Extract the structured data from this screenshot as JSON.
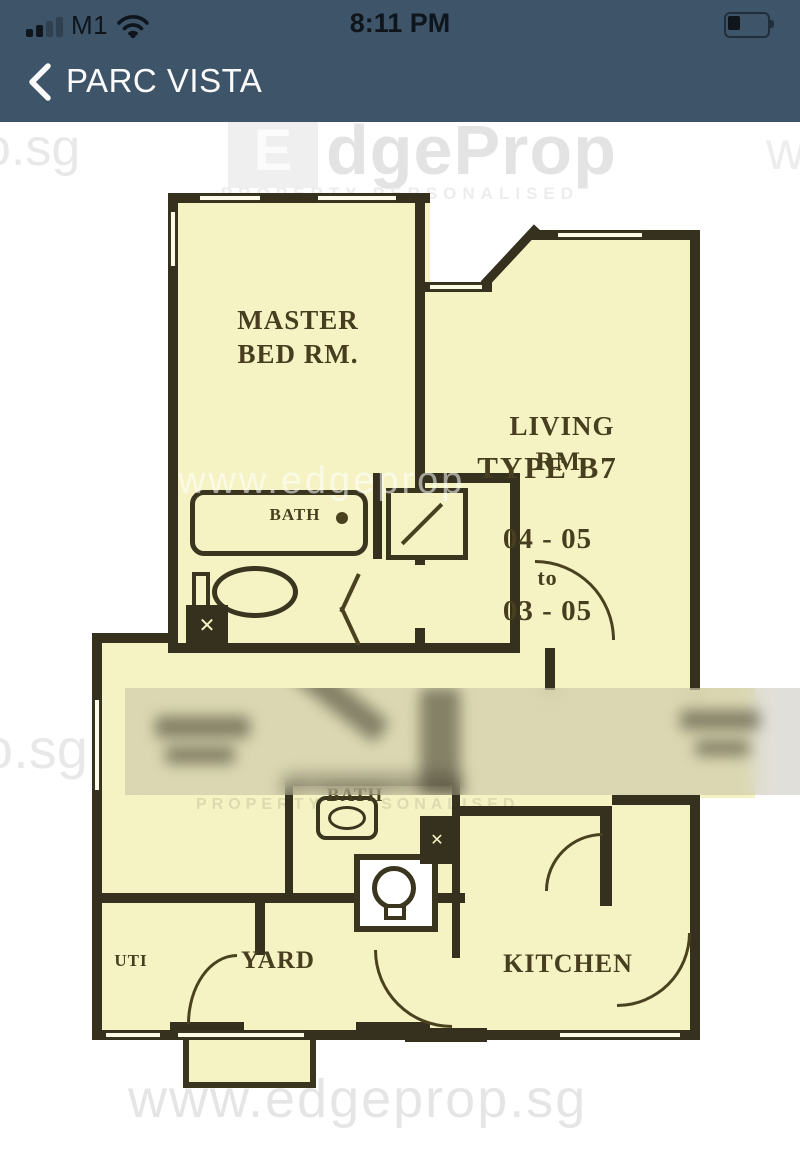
{
  "status_bar": {
    "carrier": "M1",
    "time": "8:11 PM"
  },
  "nav_bar": {
    "title": "PARC VISTA"
  },
  "watermarks": {
    "brand_e": "E",
    "brand_rest": "dgeProp",
    "tagline_top": "PROPERTY PERSONALISED",
    "tagline_mid": "PROPERTY PERSONALISED",
    "sg_top_left": "o.sg",
    "w_top_right": "w",
    "url_mid": "www.edgeprop",
    "sg_mid_left": "o.sg",
    "url_bottom": "www.edgeprop.sg"
  },
  "floor_plan": {
    "title": "TYPE B7",
    "unit_range": {
      "from": "04 - 05",
      "connector": "to",
      "to": "03 - 05"
    },
    "rooms": {
      "master_line1": "MASTER",
      "master_line2": "BED RM.",
      "living_line1": "LIVING",
      "living_line2": "RM.",
      "bath_master": "BATH",
      "bath_common": "BATH",
      "utility": "UTI",
      "yard": "YARD",
      "kitchen": "KITCHEN"
    },
    "fixture_marks": {
      "duct_cross": "✕",
      "wc_cross": "✕"
    }
  },
  "colors": {
    "header": "#3E5469",
    "plan_fill": "#F5F3C3",
    "wall": "#35311E",
    "watermark_gray": "#E3E3E3"
  }
}
